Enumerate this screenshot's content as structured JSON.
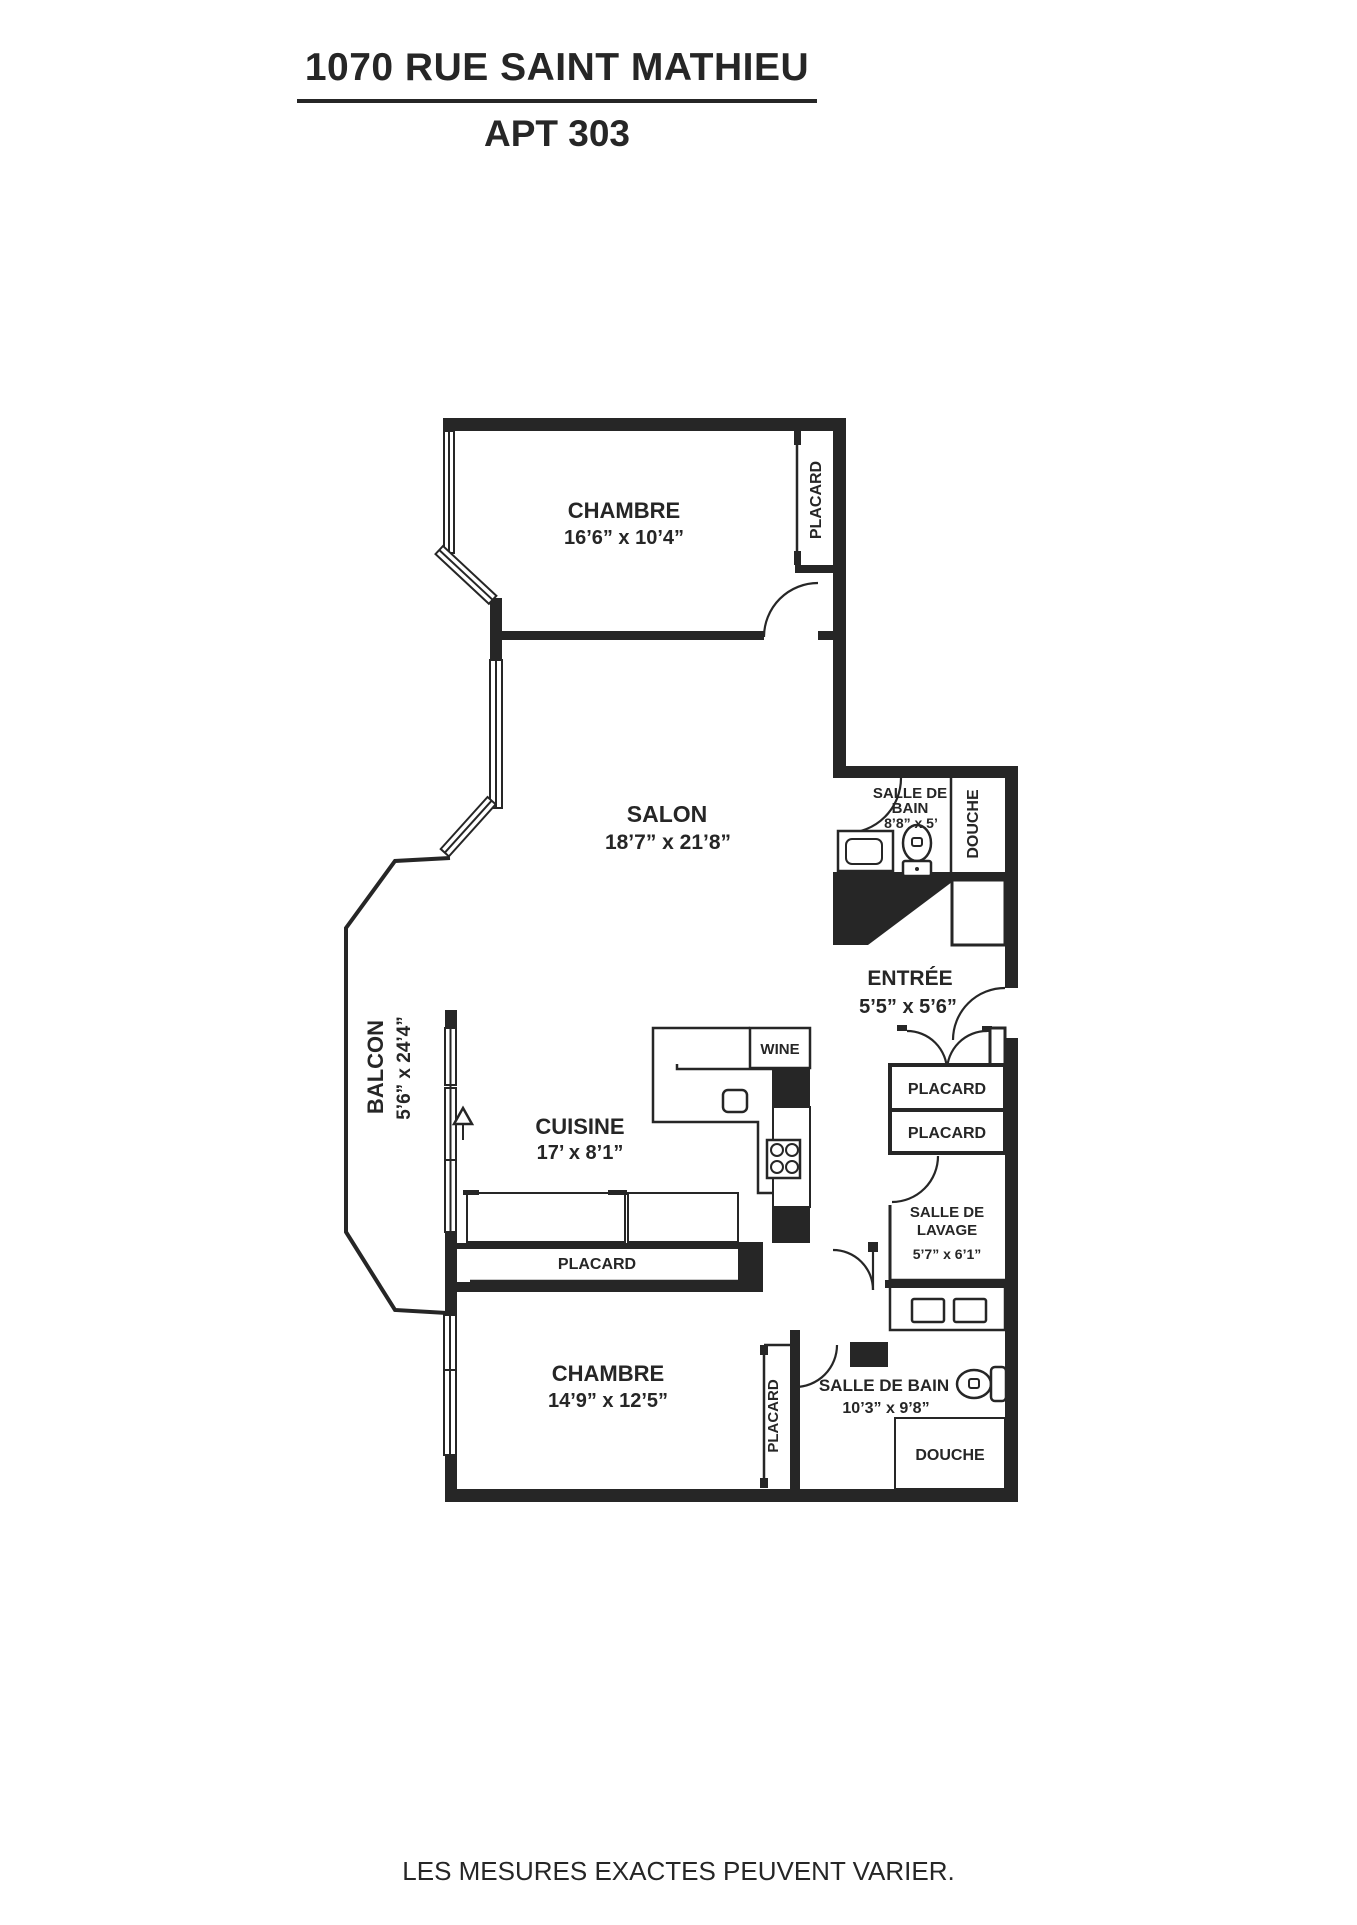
{
  "title": {
    "line1": "1070 RUE SAINT MATHIEU",
    "line2": "APT 303"
  },
  "footer": "LES MESURES EXACTES PEUVENT VARIER.",
  "colors": {
    "ink": "#262626",
    "background": "#ffffff"
  },
  "rooms": {
    "chambre1": {
      "name": "CHAMBRE",
      "dims": "16’6” x 10’4”"
    },
    "placard_chambre1": {
      "name": "PLACARD"
    },
    "salon": {
      "name": "SALON",
      "dims": "18’7” x 21’8”"
    },
    "bain1": {
      "name_line1": "SALLE DE",
      "name_line2": "BAIN",
      "dims": "8’8” x 5’"
    },
    "douche1": {
      "name": "DOUCHE"
    },
    "entree": {
      "name": "ENTRÉE",
      "dims": "5’5” x 5’6”"
    },
    "balcon": {
      "name": "BALCON",
      "dims": "5’6” x 24’4”"
    },
    "cuisine": {
      "name": "CUISINE",
      "dims": "17’ x 8’1”"
    },
    "wine": {
      "name": "WINE"
    },
    "placard_entree_1": {
      "name": "PLACARD"
    },
    "placard_entree_2": {
      "name": "PLACARD"
    },
    "placard_cuisine": {
      "name": "PLACARD"
    },
    "lavage": {
      "name_line1": "SALLE DE",
      "name_line2": "LAVAGE",
      "dims": "5’7” x 6’1”"
    },
    "chambre2": {
      "name": "CHAMBRE",
      "dims": "14’9” x 12’5”"
    },
    "placard_chambre2": {
      "name": "PLACARD"
    },
    "bain2": {
      "name": "SALLE DE BAIN",
      "dims": "10’3” x 9’8”"
    },
    "douche2": {
      "name": "DOUCHE"
    }
  }
}
